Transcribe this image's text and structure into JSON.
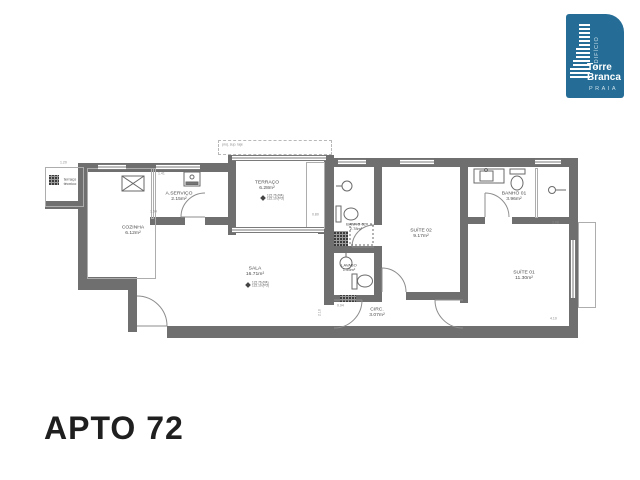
{
  "title": "APTO 72",
  "logo": {
    "edificio": "EDIFÍCIO",
    "name_line1": "Torre",
    "name_line2": "Branca",
    "subtitle": "PRAIA",
    "color": "#256d96"
  },
  "rooms": {
    "terraco_tecnico": {
      "name": "terraço",
      "name2": "técnico"
    },
    "cozinha": {
      "name": "COZINHA",
      "area": "6.12m²"
    },
    "a_servico": {
      "name": "A.SERVIÇO",
      "area": "2.15m²"
    },
    "terraco": {
      "name": "TERRAÇO",
      "area": "6.28m²",
      "level_pa": "122.76 (PA)",
      "level_po": "122.10 (PO)"
    },
    "sala": {
      "name": "SALA",
      "area": "16.71m²",
      "level_pa": "122.76 (PA)",
      "level_po": "122.10 (PO)"
    },
    "banho02": {
      "name": "BANHO 02",
      "area": "2.78m²"
    },
    "suite02": {
      "name": "SUÍTE 02",
      "area": "9.17m²"
    },
    "lavabo": {
      "name": "LAVABO",
      "area": "1.55m²"
    },
    "circ": {
      "name": "CIRC.",
      "area": "3.07m²"
    },
    "suite01": {
      "name": "SUÍTE 01",
      "area": "11.30m²"
    },
    "banho01": {
      "name": "BANHO 01",
      "area": "3.96m²"
    }
  },
  "annotations": {
    "projection": "proj. sup. laje"
  },
  "dims": {
    "d1": "1.41",
    "d2": "1.54",
    "d3": "1.20",
    "d4": "0.80",
    "d5": "3.08",
    "d6": "4.10",
    "d7": "2.10",
    "d8": "0.94"
  },
  "colors": {
    "wall": "#6f6f6f",
    "thin_line": "#adadad",
    "logo_blue": "#256d96",
    "title_text": "#1f1f1f"
  }
}
